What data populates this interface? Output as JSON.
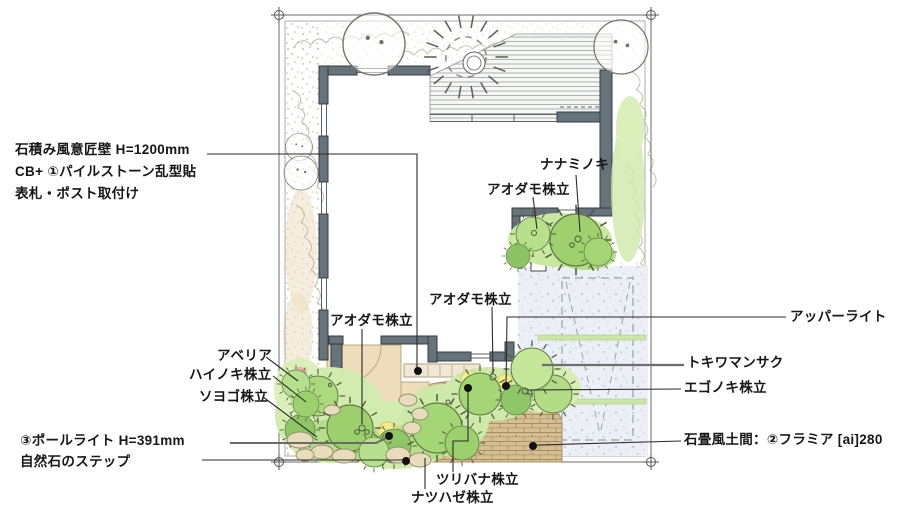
{
  "annotations": {
    "wall_note": {
      "line1": "石積み風意匠壁 H=1200mm",
      "line2": "CB+ ①パイルストーン乱型貼",
      "line3": "表札・ポスト取付け"
    },
    "nanaminoki": "ナナミノキ",
    "aodamo_right": "アオダモ株立",
    "aodamo_center": "アオダモ株立",
    "aodamo_left": "アオダモ株立",
    "abelia": "アベリア",
    "hainoki": "ハイノキ株立",
    "soyogo": "ソヨゴ株立",
    "pole_light": "③ポールライト H=391mm",
    "natural_stone_steps": "自然石のステップ",
    "tsuribana": "ツリバナ株立",
    "natsuhaze": "ナツハゼ株立",
    "upper_light": "アッパーライト",
    "tokiwamansaku": "トキワマンサク",
    "egonoki": "エゴノキ株立",
    "stone_floor": "石畳風土間：②フラミア [ai]280"
  },
  "colors": {
    "leader_line": "#2b2b2b",
    "wall_fill": "#67737a",
    "green_light": "#d2ebae",
    "green_mid": "#b5dd8a",
    "brick": "#d7bf94",
    "accent_light_yellow": "#f3ec8e",
    "concrete": "#edeff6"
  }
}
